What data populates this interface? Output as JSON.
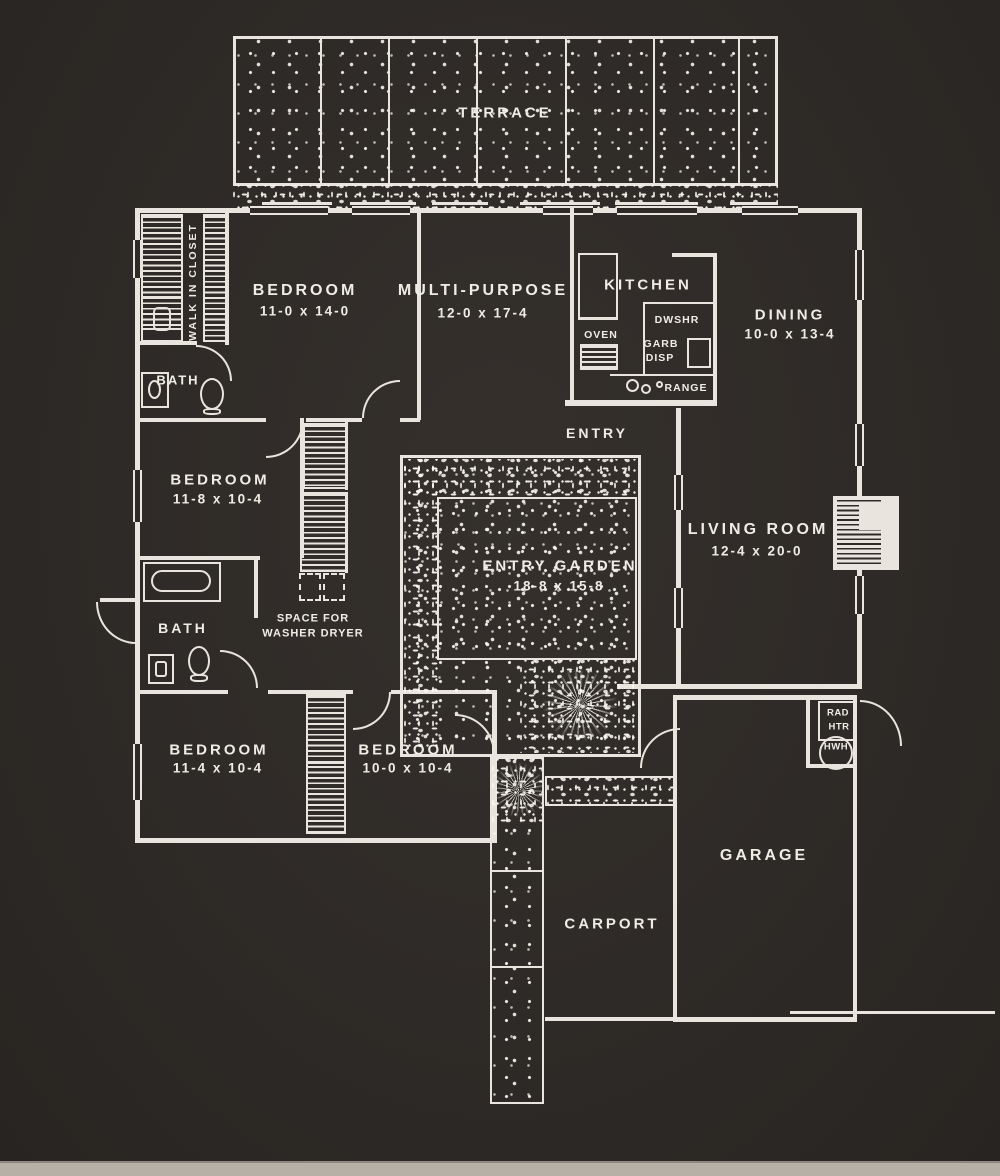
{
  "meta": {
    "type": "architectural floor plan",
    "style": "white line drawing on dark charcoal background"
  },
  "colors": {
    "background": "#2e2a27",
    "line": "#e9e5de",
    "text": "#efece5",
    "scan_edge": "#b6b0a7"
  },
  "labels": {
    "terrace": "TERRACE",
    "bedroom1_name": "BEDROOM",
    "bedroom1_dims": "11-0 x 14-0",
    "multipurpose_name": "MULTI-PURPOSE",
    "multipurpose_dims": "12-0 x 17-4",
    "kitchen": "KITCHEN",
    "oven": "OVEN",
    "dwshr": "DWSHR",
    "garb": "GARB",
    "disp": "DISP",
    "range": "RANGE",
    "dining_name": "DINING",
    "dining_dims": "10-0 x 13-4",
    "walk_in_closet": "WALK IN CLOSET",
    "bath1": "BATH",
    "bedroom2_name": "BEDROOM",
    "bedroom2_dims": "11-8 x 10-4",
    "entry": "ENTRY",
    "garden_name": "ENTRY GARDEN",
    "garden_dims": "18-8 x 15-8",
    "living_name": "LIVING ROOM",
    "living_dims": "12-4 x 20-0",
    "bath2": "BATH",
    "laundry_line1": "SPACE FOR",
    "laundry_line2": "WASHER DRYER",
    "bedroom3_name": "BEDROOM",
    "bedroom3_dims": "11-4 x 10-4",
    "bedroom4_name": "BEDROOM",
    "bedroom4_dims": "10-0 x 10-4",
    "garage": "GARAGE",
    "carport": "CARPORT",
    "rad": "RAD",
    "htr": "HTR",
    "hwh": "HWH"
  }
}
